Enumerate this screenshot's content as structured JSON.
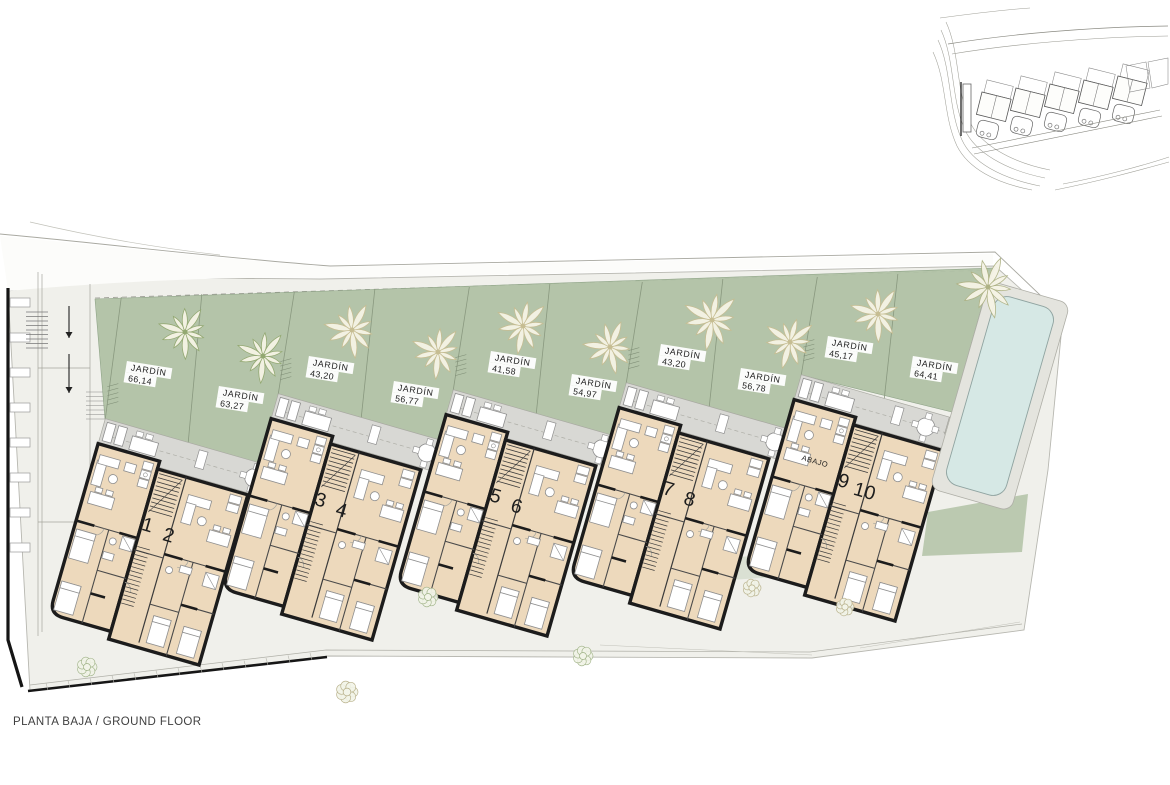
{
  "plan": {
    "floor_label": "PLANTA BAJA / GROUND FLOOR",
    "abajo_label": "ABAJO",
    "blocks": [
      {
        "units": [
          "1",
          "2"
        ],
        "gardens": [
          {
            "label": "JARDÍN",
            "area": "66,14"
          },
          {
            "label": "JARDÍN",
            "area": "63,27"
          }
        ]
      },
      {
        "units": [
          "3",
          "4"
        ],
        "gardens": [
          {
            "label": "JARDÍN",
            "area": "43,20"
          },
          {
            "label": "JARDÍN",
            "area": "56,77"
          }
        ]
      },
      {
        "units": [
          "5",
          "6"
        ],
        "gardens": [
          {
            "label": "JARDÍN",
            "area": "41,58"
          },
          {
            "label": "JARDÍN",
            "area": "54,97"
          }
        ]
      },
      {
        "units": [
          "7",
          "8"
        ],
        "gardens": [
          {
            "label": "JARDÍN",
            "area": "43,20"
          },
          {
            "label": "JARDÍN",
            "area": "56,78"
          }
        ]
      },
      {
        "units": [
          "9",
          "10"
        ],
        "gardens": [
          {
            "label": "JARDÍN",
            "area": "45,17"
          },
          {
            "label": "JARDÍN",
            "area": "64,41"
          }
        ]
      }
    ],
    "colors": {
      "site": "#f0f0eb",
      "garden": "#b1c2a6",
      "terrace": "#d8d8d4",
      "floor": "#edd9bc",
      "wall": "#1c1c1c",
      "pool": "#d6e8e5",
      "pool_walk": "#e4e4de",
      "palm_green": "#93a871",
      "palm_khaki": "#c6bd92",
      "bush": "#9fb286",
      "line": "#9a9a92",
      "furniture": "#8f8f8f"
    }
  }
}
